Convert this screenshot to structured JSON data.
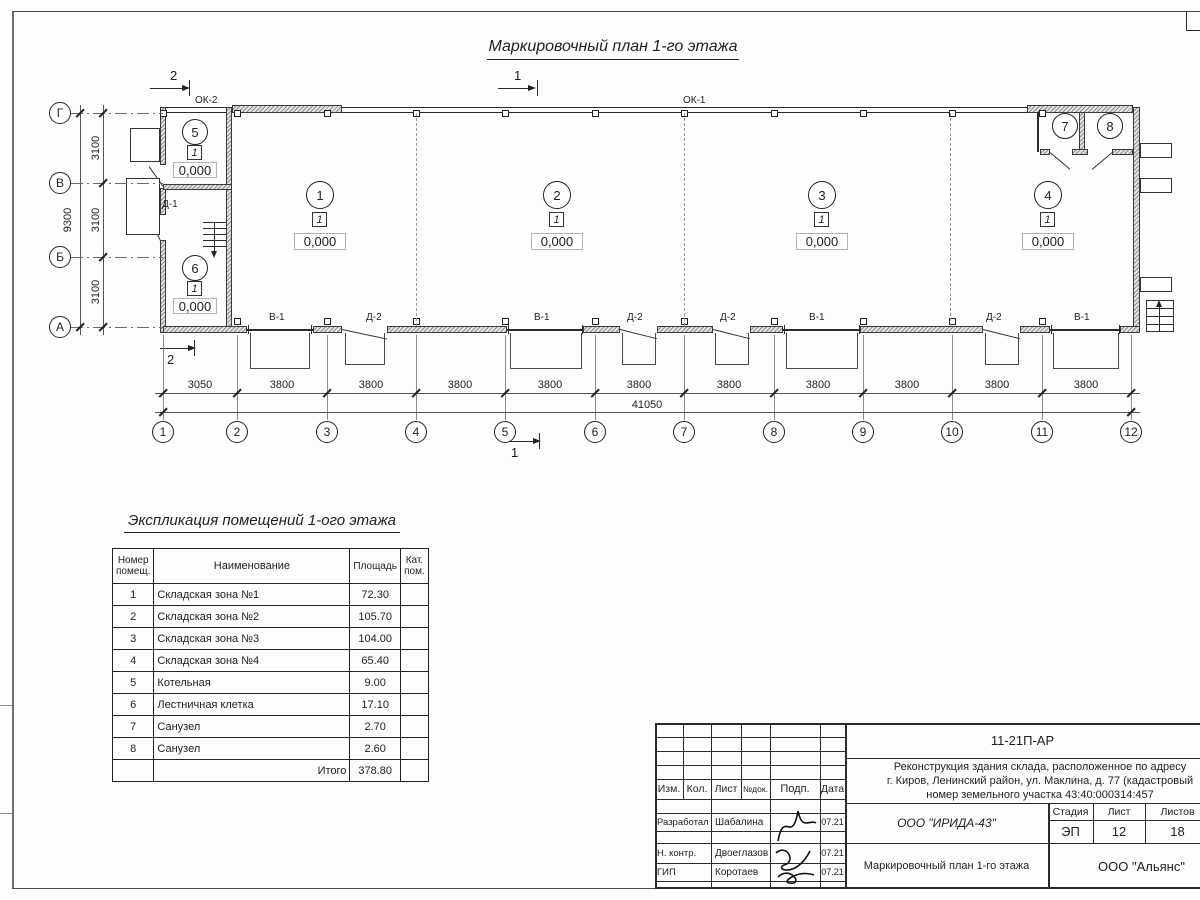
{
  "plan": {
    "title": "Маркировочный план 1-го этажа",
    "axis_rows": [
      "Г",
      "В",
      "Б",
      "А"
    ],
    "axis_cols": [
      "1",
      "2",
      "3",
      "4",
      "5",
      "6",
      "7",
      "8",
      "9",
      "10",
      "11",
      "12"
    ],
    "row_dims": [
      "3100",
      "3100",
      "3100"
    ],
    "row_total": "9300",
    "col_dims": [
      "3050",
      "3800",
      "3800",
      "3800",
      "3800",
      "3800",
      "3800",
      "3800",
      "3800",
      "3800",
      "3800"
    ],
    "col_total": "41050",
    "window_bands": {
      "ok1": "ОК-1",
      "ok2": "ОК-2"
    },
    "door_marks": {
      "d1": "Д-1"
    },
    "section_marks": {
      "m1": "1",
      "m2": "2"
    },
    "room_bubbles": [
      "1",
      "2",
      "3",
      "4",
      "5",
      "6",
      "7",
      "8"
    ],
    "zone_marker": "1",
    "elevation": "0,000",
    "bottom_openings": [
      "В-1",
      "Д-2",
      "В-1",
      "Д-2",
      "Д-2",
      "В-1",
      "Д-2",
      "В-1"
    ]
  },
  "schedule": {
    "title": "Экспликация помещений 1-ого этажа",
    "headers": [
      "Номер помещ.",
      "Наименование",
      "Площадь",
      "Кат. пом."
    ],
    "rows": [
      {
        "num": "1",
        "name": "Складская зона №1",
        "area": "72.30",
        "cat": ""
      },
      {
        "num": "2",
        "name": "Складская зона №2",
        "area": "105.70",
        "cat": ""
      },
      {
        "num": "3",
        "name": "Складская зона №3",
        "area": "104.00",
        "cat": ""
      },
      {
        "num": "4",
        "name": "Складская зона №4",
        "area": "65.40",
        "cat": ""
      },
      {
        "num": "5",
        "name": "Котельная",
        "area": "9.00",
        "cat": ""
      },
      {
        "num": "6",
        "name": "Лестничная клетка",
        "area": "17.10",
        "cat": ""
      },
      {
        "num": "7",
        "name": "Санузел",
        "area": "2.70",
        "cat": ""
      },
      {
        "num": "8",
        "name": "Санузел",
        "area": "2.60",
        "cat": ""
      }
    ],
    "total_label": "Итого",
    "total_value": "378.80"
  },
  "titleblock": {
    "doc_code": "11-21П-АР",
    "project_lines": [
      "Реконструкция здания склада, расположенное по адресу",
      "г. Киров, Ленинский район, ул. Маклина, д. 77 (кадастровый",
      "номер земельного участка 43:40:000314:457"
    ],
    "header_cells": [
      "Изм.",
      "Кол.",
      "Лист",
      "№док.",
      "Подп.",
      "Дата"
    ],
    "sign_rows": [
      {
        "role": "Разработал",
        "name": "Шабалина",
        "date": "07.21"
      },
      {
        "role": "Н. контр.",
        "name": "Двоеглазов",
        "date": "07.21"
      },
      {
        "role": "ГИП",
        "name": "Коротаев",
        "date": "07.21"
      }
    ],
    "org": "ООО \"ИРИДА-43\"",
    "stage_headers": [
      "Стадия",
      "Лист",
      "Листов"
    ],
    "stage_values": [
      "ЭП",
      "12",
      "18"
    ],
    "drawing_name": "Маркировочный план 1-го этажа",
    "contractor": "ООО \"Альянс\""
  }
}
